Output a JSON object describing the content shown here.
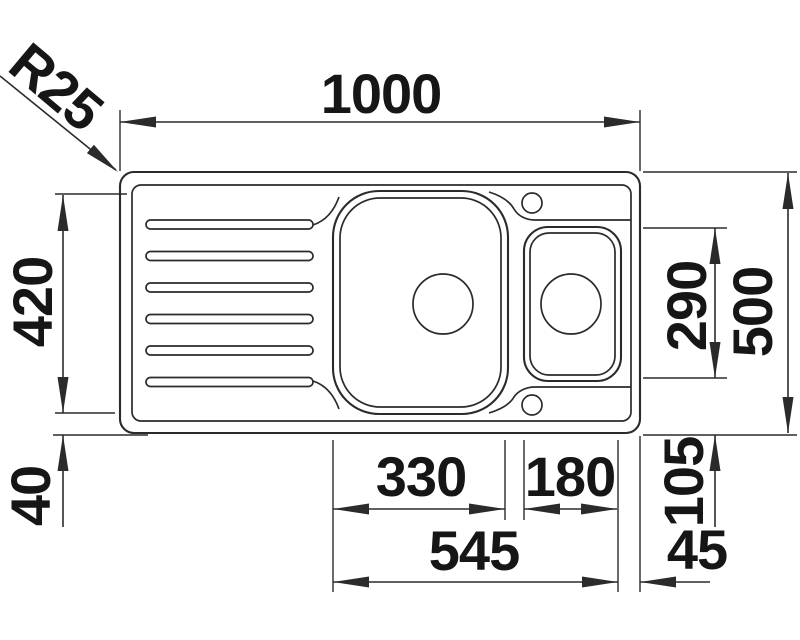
{
  "drawing_type": "kitchen-sink-top-view-dimension-drawing",
  "colors": {
    "line": "#2b2b2b",
    "text": "#161616",
    "background": "#ffffff"
  },
  "labels": {
    "overall_width": "1000",
    "corner_radius": "R25",
    "drainer_length": "420",
    "rim_offset_left": "40",
    "small_bowl_height": "290",
    "overall_depth": "500",
    "rim_offset_right": "105",
    "main_bowl_width": "330",
    "small_bowl_width": "180",
    "bowls_total_width": "545",
    "rim_offset_end": "45"
  }
}
